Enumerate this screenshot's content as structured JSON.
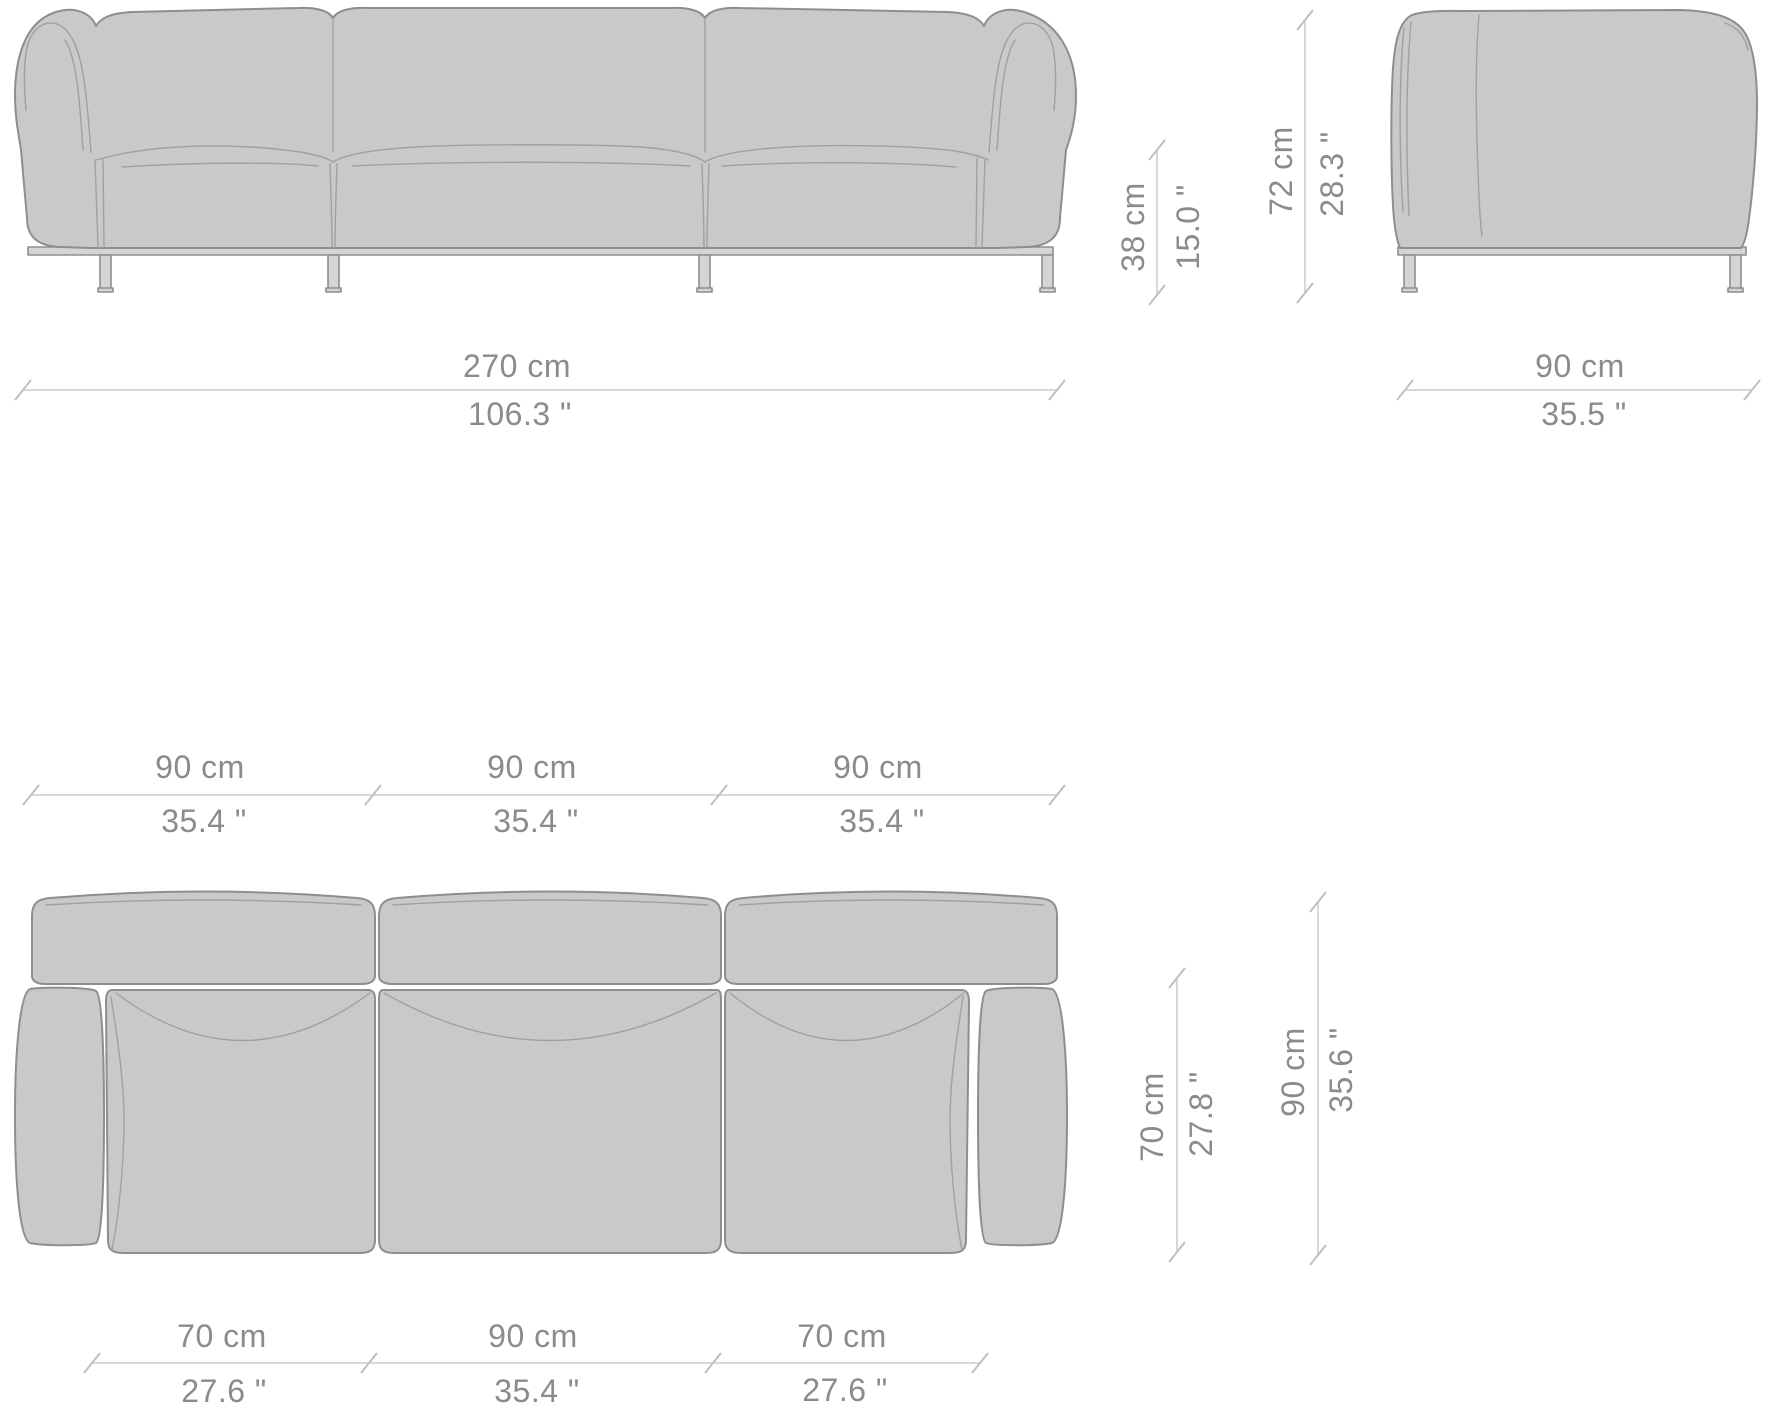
{
  "drawing": {
    "type": "furniture-dimension-diagram",
    "subject": "three-seat sofa orthographic views (front elevation, side elevation, top plan)",
    "colors": {
      "body_fill": "#c9c9c9",
      "outline": "#8e8e8e",
      "seam": "#a0a0a0",
      "frame_fill": "#d5d5d5",
      "dim_line": "#cccccc",
      "dim_tick": "#c0c0c0",
      "dim_text": "#8b8b8b",
      "background": "#ffffff"
    },
    "views": {
      "front": "front-elevation",
      "side": "side-elevation",
      "top": "top-plan"
    },
    "dims": {
      "overall_width": {
        "cm": "270 cm",
        "inch": "106.3 \""
      },
      "side_depth": {
        "cm": "90 cm",
        "inch": "35.5 \""
      },
      "seat_height": {
        "cm": "38 cm",
        "inch": "15.0 \""
      },
      "overall_height": {
        "cm": "72 cm",
        "inch": "28.3 \""
      },
      "module_1": {
        "cm": "90 cm",
        "inch": "35.4 \""
      },
      "module_2": {
        "cm": "90 cm",
        "inch": "35.4 \""
      },
      "module_3": {
        "cm": "90 cm",
        "inch": "35.4 \""
      },
      "seat_depth": {
        "cm": "70 cm",
        "inch": "27.8 \""
      },
      "overall_depth": {
        "cm": "90 cm",
        "inch": "35.6 \""
      },
      "seat_left_width": {
        "cm": "70 cm",
        "inch": "27.6 \""
      },
      "seat_center_width": {
        "cm": "90 cm",
        "inch": "35.4 \""
      },
      "seat_right_width": {
        "cm": "70 cm",
        "inch": "27.6 \""
      }
    }
  }
}
